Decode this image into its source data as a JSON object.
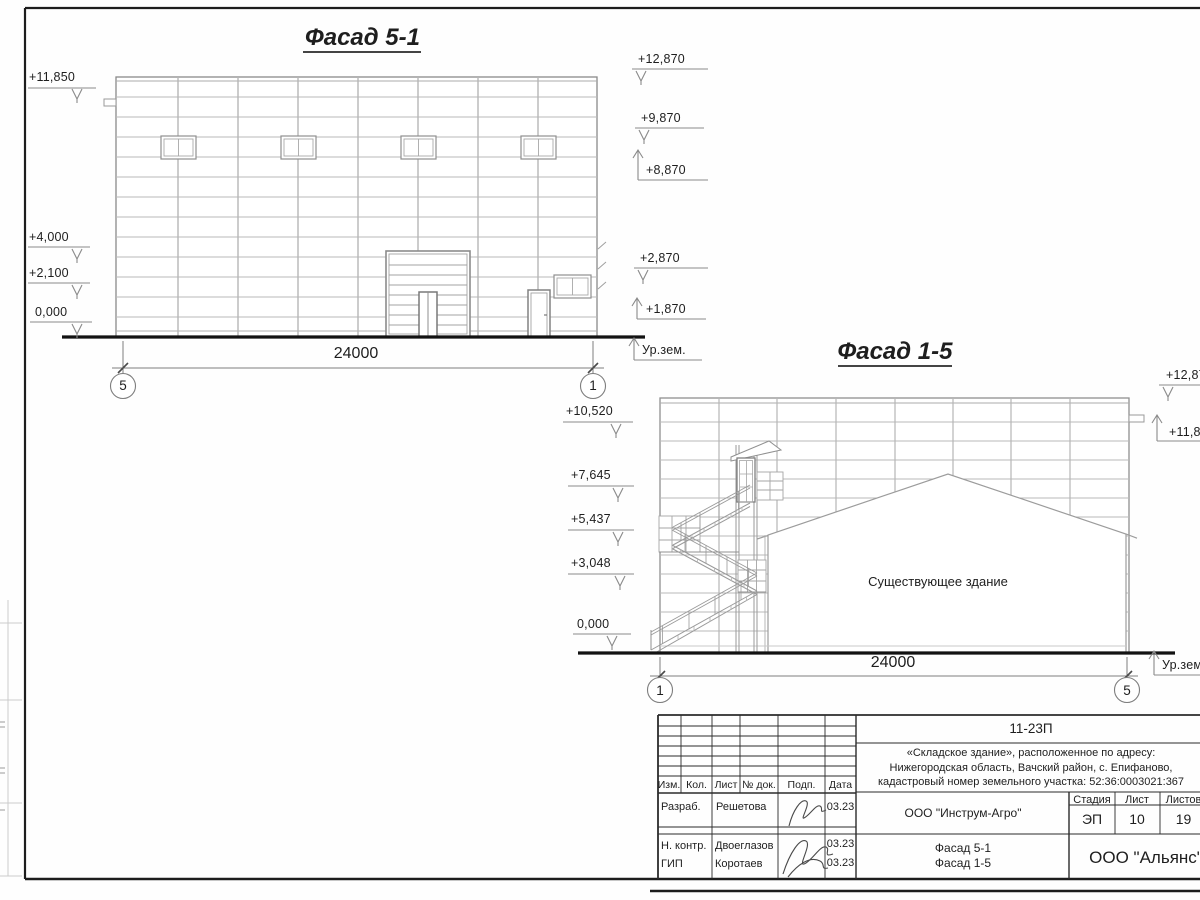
{
  "facade_51": {
    "title": "Фасад 5-1",
    "levels_left": [
      {
        "text": "+11,850"
      },
      {
        "text": "+4,000"
      },
      {
        "text": "+2,100"
      },
      {
        "text": "0,000"
      }
    ],
    "levels_right": [
      {
        "text": "+12,870"
      },
      {
        "text": "+9,870"
      },
      {
        "text": "+8,870"
      },
      {
        "text": "+2,870"
      },
      {
        "text": "+1,870"
      }
    ],
    "ground_label": "Ур.зем.",
    "dimension": "24000",
    "axis_left": "5",
    "axis_right": "1"
  },
  "facade_15": {
    "title": "Фасад 1-5",
    "levels_left": [
      {
        "text": "+10,520"
      },
      {
        "text": "+7,645"
      },
      {
        "text": "+5,437"
      },
      {
        "text": "+3,048"
      },
      {
        "text": "0,000"
      }
    ],
    "levels_right": [
      {
        "text": "+12,870"
      },
      {
        "text": "+11,850"
      }
    ],
    "ground_label": "Ур.зем.",
    "existing_building_label": "Существующее здание",
    "dimension": "24000",
    "axis_left": "1",
    "axis_right": "5"
  },
  "title_block": {
    "doc_number": "11-23П",
    "project_lines": [
      "«Складское здание», расположенное по адресу:",
      "Нижегородская область, Вачский район, с. Епифаново,",
      "кадастровый номер земельного участка: 52:36:0003021:367"
    ],
    "rev_headers": [
      "Изм.",
      "Кол.",
      "Лист",
      "№ док.",
      "Подп.",
      "Дата"
    ],
    "signature_rows": [
      {
        "role": "Разраб.",
        "name": "Решетова",
        "date": "03.23"
      },
      {
        "role": "Н. контр.",
        "name": "Двоеглазов",
        "date": "03.23"
      },
      {
        "role": "ГИП",
        "name": "Коротаев",
        "date": "03.23"
      }
    ],
    "client": "ООО \"Инструм-Агро\"",
    "stage_label": "Стадия",
    "sheet_label": "Лист",
    "sheets_label": "Листов",
    "stage": "ЭП",
    "sheet_no": "10",
    "sheets_total": "19",
    "sheet_titles": [
      "Фасад 5-1",
      "Фасад 1-5"
    ],
    "organization": "ООО \"Альянс\""
  }
}
